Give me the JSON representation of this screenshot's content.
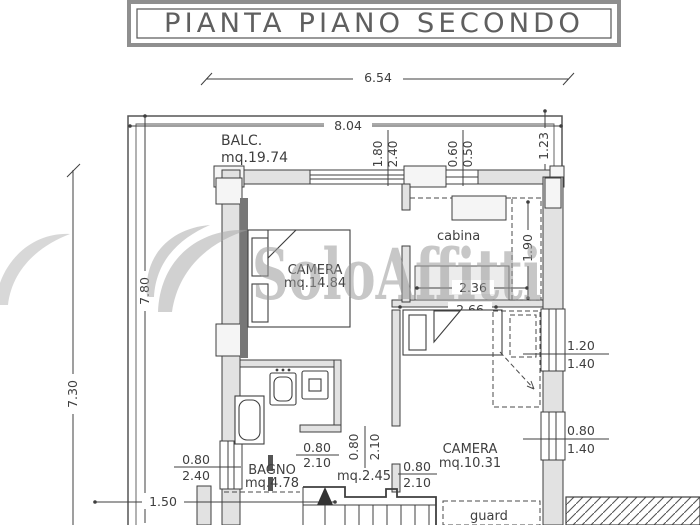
{
  "title": "PIANTA PIANO SECONDO",
  "watermark": "SoloAffitti",
  "rooms": {
    "balcony": {
      "name": "BALC.",
      "area": "mq.19.74"
    },
    "camera1": {
      "name": "CAMERA",
      "area": "mq.14.84"
    },
    "cabina": {
      "name": "cabina"
    },
    "camera2": {
      "name": "CAMERA",
      "area": "mq.10.31"
    },
    "bagno": {
      "name": "BAGNO",
      "area": "mq.4.78"
    },
    "hall": {
      "area": "mq.2.45"
    },
    "wardrobe": {
      "name": "guard"
    }
  },
  "dims": {
    "total_width": "6.54",
    "balcony_width": "8.04",
    "left_outer_height": "7.30",
    "left_inner_height": "7.80",
    "balcony_right_depth": "1.23",
    "bottom_left": "1.50",
    "cabina_width": "2.36",
    "cabina_depth": "1.90",
    "camera2_width": "2.66"
  },
  "windows": {
    "top_large": {
      "w": "1.80",
      "h": "2.40"
    },
    "top_small": {
      "w": "0.60",
      "h": "0.50"
    },
    "right_up": {
      "w": "1.20",
      "h": "1.40"
    },
    "right_down": {
      "w": "0.80",
      "h": "1.40"
    },
    "left_low": {
      "w": "0.80",
      "h": "2.40"
    }
  },
  "doors": {
    "bagno": {
      "w": "0.80",
      "h": "2.10"
    },
    "hall": {
      "w": "0.80",
      "h": "2.10"
    },
    "camera2": {
      "w": "0.80",
      "h": "2.10"
    }
  },
  "colors": {
    "line": "#3f3f3f",
    "wall_fill": "#e2e2e2",
    "dark_fill": "#777777",
    "watermark": "#9b9b9b",
    "paper": "#ffffff"
  }
}
